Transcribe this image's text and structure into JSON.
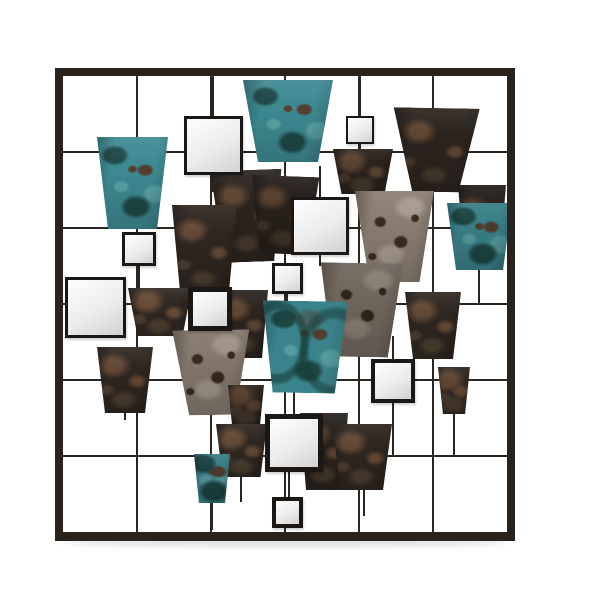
{
  "scene": {
    "kind": "product-photo",
    "subject": "square metal wall-art sculpture: wire grid frame with patina pot shapes and square mirrors",
    "background": "#ffffff"
  },
  "colors": {
    "frame": "#2a221d",
    "wire": "#2c241f",
    "mirror_frame": "#1b1714",
    "mirror_light": "#fbfbfb",
    "mirror_dark": "#d4d4d4",
    "teal": "#3e8a92",
    "teal_dark": "#1e4a47",
    "teal_light": "#5aa4a6",
    "teal_fleck": "#54402f",
    "dark": "#2c241f",
    "dark_rust": "#5e4633",
    "dark_light": "#473a2e",
    "gray": "#8a7e73",
    "gray_dark": "#382c22",
    "gray_light": "#a59a8d",
    "shadow": "rgba(0,0,0,0.12)"
  },
  "frame": {
    "x": 55,
    "y": 68,
    "w": 460,
    "h": 473,
    "border": 8
  },
  "grid": {
    "inner": {
      "x": 8,
      "y": 8,
      "w": 444,
      "h": 457
    },
    "cols": [
      82,
      156,
      230,
      304,
      378
    ],
    "rows": [
      84,
      160,
      236,
      312,
      388
    ],
    "line_w": 2
  },
  "stubs": [
    {
      "x": 158,
      "y1": 8,
      "y2": 50
    },
    {
      "x": 158,
      "y1": 105,
      "y2": 124
    },
    {
      "x": 305,
      "y1": 8,
      "y2": 50
    },
    {
      "x": 305,
      "y1": 74,
      "y2": 86
    },
    {
      "x": 265,
      "y1": 98,
      "y2": 131
    },
    {
      "x": 265,
      "y1": 185,
      "y2": 198
    },
    {
      "x": 232,
      "y1": 224,
      "y2": 240
    },
    {
      "x": 84,
      "y1": 198,
      "y2": 222
    },
    {
      "x": 338,
      "y1": 268,
      "y2": 293
    },
    {
      "x": 338,
      "y1": 333,
      "y2": 388
    },
    {
      "x": 239,
      "y1": 312,
      "y2": 348
    },
    {
      "x": 234,
      "y1": 403,
      "y2": 431
    },
    {
      "x": 157,
      "y1": 433,
      "y2": 462
    },
    {
      "x": 399,
      "y1": 344,
      "y2": 388
    },
    {
      "x": 186,
      "y1": 407,
      "y2": 434
    },
    {
      "x": 309,
      "y1": 420,
      "y2": 448
    },
    {
      "x": 70,
      "y1": 343,
      "y2": 352
    },
    {
      "x": 424,
      "y1": 202,
      "y2": 236
    }
  ],
  "pots": [
    {
      "x": 403,
      "y": 117,
      "tw": 48,
      "bw": 34,
      "h": 85,
      "type": "dark",
      "rot": 0,
      "dim": 0.85
    },
    {
      "x": 338,
      "y": 40,
      "tw": 86,
      "bw": 46,
      "h": 84,
      "type": "dark",
      "rot": 1,
      "dim": 1
    },
    {
      "x": 278,
      "y": 81,
      "tw": 60,
      "bw": 43,
      "h": 45,
      "type": "dark",
      "rot": 0,
      "dim": 0.95
    },
    {
      "x": 157,
      "y": 102,
      "tw": 71,
      "bw": 50,
      "h": 92,
      "type": "dark",
      "rot": -2,
      "dim": 1
    },
    {
      "x": 196,
      "y": 108,
      "tw": 67,
      "bw": 47,
      "h": 78,
      "type": "dark",
      "rot": 2,
      "dim": 0.9
    },
    {
      "x": 117,
      "y": 137,
      "tw": 65,
      "bw": 48,
      "h": 92,
      "type": "dark",
      "rot": 0,
      "dim": 1.05
    },
    {
      "x": 73,
      "y": 220,
      "tw": 64,
      "bw": 45,
      "h": 48,
      "type": "dark",
      "rot": 0,
      "dim": 1.1
    },
    {
      "x": 165,
      "y": 222,
      "tw": 48,
      "bw": 36,
      "h": 68,
      "type": "dark",
      "rot": 0,
      "dim": 1
    },
    {
      "x": 300,
      "y": 123,
      "tw": 79,
      "bw": 50,
      "h": 91,
      "type": "gray",
      "rot": 0,
      "dim": 1
    },
    {
      "x": 265,
      "y": 195,
      "tw": 82,
      "bw": 55,
      "h": 94,
      "type": "gray",
      "rot": 1,
      "dim": 0.82
    },
    {
      "x": 350,
      "y": 224,
      "tw": 56,
      "bw": 40,
      "h": 67,
      "type": "dark",
      "rot": 0,
      "dim": 1.05
    },
    {
      "x": 118,
      "y": 262,
      "tw": 77,
      "bw": 46,
      "h": 85,
      "type": "gray",
      "rot": -1,
      "dim": 0.95
    },
    {
      "x": 42,
      "y": 279,
      "tw": 56,
      "bw": 40,
      "h": 66,
      "type": "dark",
      "rot": 0,
      "dim": 1.05
    },
    {
      "x": 245,
      "y": 345,
      "tw": 48,
      "bw": 36,
      "h": 77,
      "type": "dark",
      "rot": 0,
      "dim": 0.95
    },
    {
      "x": 173,
      "y": 317,
      "tw": 36,
      "bw": 28,
      "h": 40,
      "type": "dark",
      "rot": 0,
      "dim": 0.9
    },
    {
      "x": 161,
      "y": 356,
      "tw": 51,
      "bw": 38,
      "h": 53,
      "type": "dark",
      "rot": 0,
      "dim": 1.05
    },
    {
      "x": 277,
      "y": 356,
      "tw": 60,
      "bw": 42,
      "h": 66,
      "type": "dark",
      "rot": 0,
      "dim": 1.05
    },
    {
      "x": 383,
      "y": 299,
      "tw": 32,
      "bw": 22,
      "h": 47,
      "type": "dark",
      "rot": 0,
      "dim": 1
    },
    {
      "x": 42,
      "y": 69,
      "tw": 71,
      "bw": 49,
      "h": 92,
      "type": "teal",
      "rot": 0,
      "dim": 1
    },
    {
      "x": 188,
      "y": 12,
      "tw": 90,
      "bw": 60,
      "h": 82,
      "type": "teal",
      "rot": 0,
      "dim": 1
    },
    {
      "x": 392,
      "y": 135,
      "tw": 65,
      "bw": 47,
      "h": 67,
      "type": "teal",
      "rot": 0,
      "dim": 0.92
    },
    {
      "x": 207,
      "y": 233,
      "tw": 85,
      "bw": 62,
      "h": 92,
      "type": "teal",
      "rot": 1,
      "dim": 0.95,
      "swirl": true
    },
    {
      "x": 139,
      "y": 386,
      "tw": 36,
      "bw": 26,
      "h": 49,
      "type": "teal",
      "rot": 0,
      "dim": 0.9
    }
  ],
  "mirrors": [
    {
      "x": 129,
      "y": 48,
      "size": 59,
      "border": 3
    },
    {
      "x": 291,
      "y": 48,
      "size": 28,
      "border": 2
    },
    {
      "x": 67,
      "y": 164,
      "size": 34,
      "border": 3
    },
    {
      "x": 10,
      "y": 209,
      "size": 61,
      "border": 3
    },
    {
      "x": 236,
      "y": 129,
      "size": 58,
      "border": 3
    },
    {
      "x": 217,
      "y": 195,
      "size": 31,
      "border": 3
    },
    {
      "x": 133,
      "y": 219,
      "size": 44,
      "border": 5
    },
    {
      "x": 316,
      "y": 291,
      "size": 44,
      "border": 4
    },
    {
      "x": 210,
      "y": 346,
      "size": 58,
      "border": 5
    },
    {
      "x": 217,
      "y": 429,
      "size": 31,
      "border": 4
    }
  ],
  "floor_shadow": {
    "x": 62,
    "y": 538,
    "w": 446,
    "h": 9
  }
}
